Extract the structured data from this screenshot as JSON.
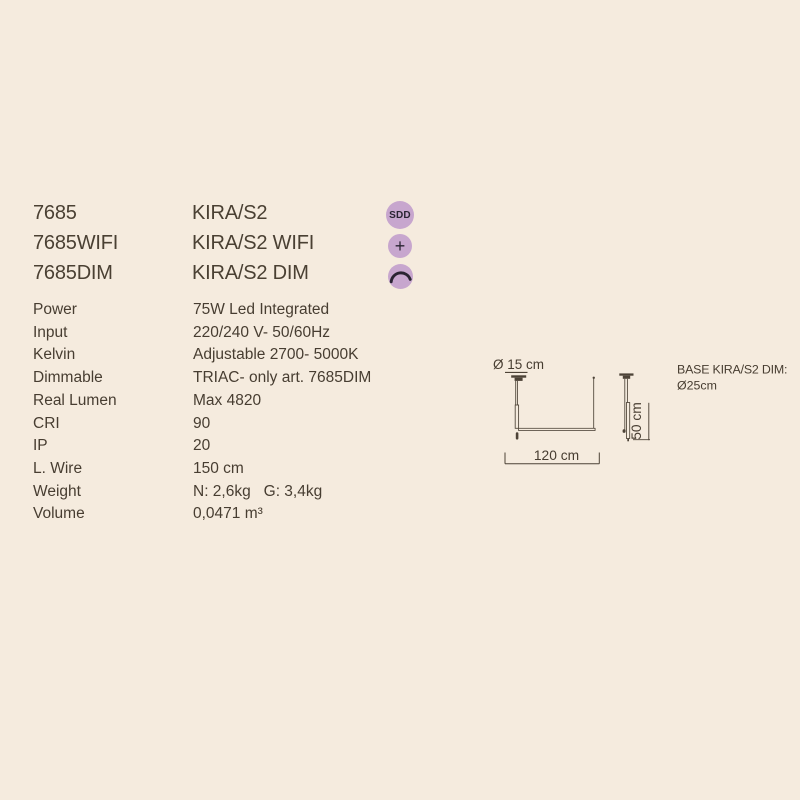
{
  "page": {
    "background": "#f5ebde",
    "text_color": "#473d31"
  },
  "products": [
    {
      "code": "7685",
      "name": "KIRA/S2",
      "badge_icon": "sdd-badge"
    },
    {
      "code": "7685WIFI",
      "name": "KIRA/S2 WIFI",
      "badge_icon": "plus-badge"
    },
    {
      "code": "7685DIM",
      "name": "KIRA/S2 DIM",
      "badge_icon": "dimmer-curve-badge"
    }
  ],
  "badges": {
    "sdd_label": "SDD",
    "plus_label": "+",
    "circle_color": "#c7a6ce",
    "glyph_color": "#2a2433"
  },
  "specs": [
    {
      "label": "Power",
      "value": "75W Led Integrated"
    },
    {
      "label": "Input",
      "value": "220/240 V- 50/60Hz"
    },
    {
      "label": "Kelvin",
      "value": "Adjustable 2700- 5000K"
    },
    {
      "label": "Dimmable",
      "value": "TRIAC- only art. 7685DIM"
    },
    {
      "label": "Real Lumen",
      "value": "Max 4820"
    },
    {
      "label": "CRI",
      "value": "90"
    },
    {
      "label": "IP",
      "value": "20"
    },
    {
      "label": "L. Wire",
      "value": "150 cm"
    },
    {
      "label": "Weight",
      "value": "N: 2,6kg   G: 3,4kg"
    },
    {
      "label": "Volume",
      "value": "0,0471 m³"
    }
  ],
  "diagram": {
    "canopy_diameter_label": "Ø 15 cm",
    "width_label": "120 cm",
    "height_label": "50 cm",
    "base_note_line1": "BASE KIRA/S2 DIM:",
    "base_note_line2": "Ø25cm",
    "line_color": "#4d4337"
  }
}
